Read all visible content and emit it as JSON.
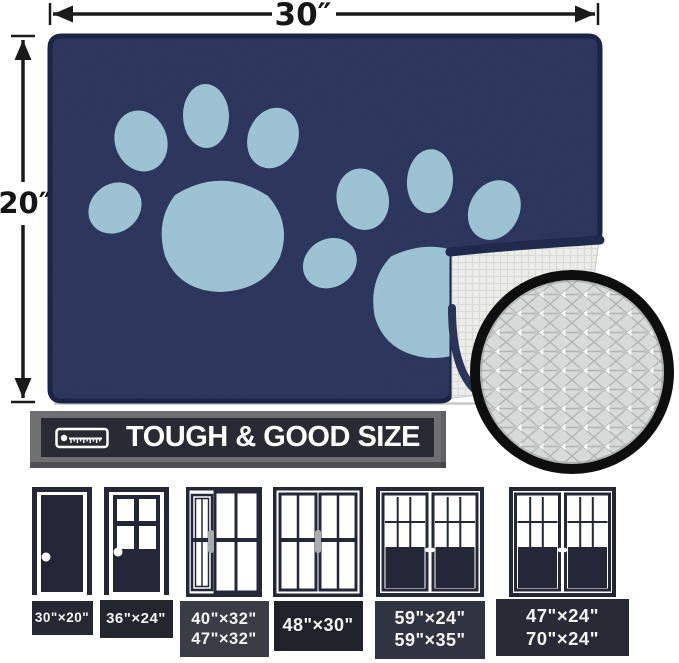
{
  "dimensions": {
    "width_label": "30″",
    "height_label": "20″"
  },
  "mat": {
    "color": "#283159",
    "paw_color": "#9ac0d2",
    "backing_color": "#ececea",
    "features": [
      "two paw prints",
      "folded corner showing non-slip backing",
      "zoom circle of diamond-textured backing"
    ]
  },
  "banner": {
    "text": "TOUGH & GOOD SIZE",
    "icon": "ruler-icon",
    "bg": "#2a2a35",
    "frame": "#6f6f74"
  },
  "doors": [
    {
      "name": "solid single door",
      "lines": [
        "30\"×20\""
      ]
    },
    {
      "name": "half-glass single door",
      "lines": [
        "36\"×24\""
      ]
    },
    {
      "name": "sliding door with sidelight",
      "lines": [
        "40\"×32\"",
        "47\"×32\""
      ]
    },
    {
      "name": "double sliding glass door",
      "lines": [
        "48\"×30\""
      ]
    },
    {
      "name": "french patio doors",
      "lines": [
        "59\"×24\"",
        "59\"×35\""
      ]
    },
    {
      "name": "wide french patio doors",
      "lines": [
        "47\"×24\"",
        "70\"×24\""
      ]
    }
  ]
}
